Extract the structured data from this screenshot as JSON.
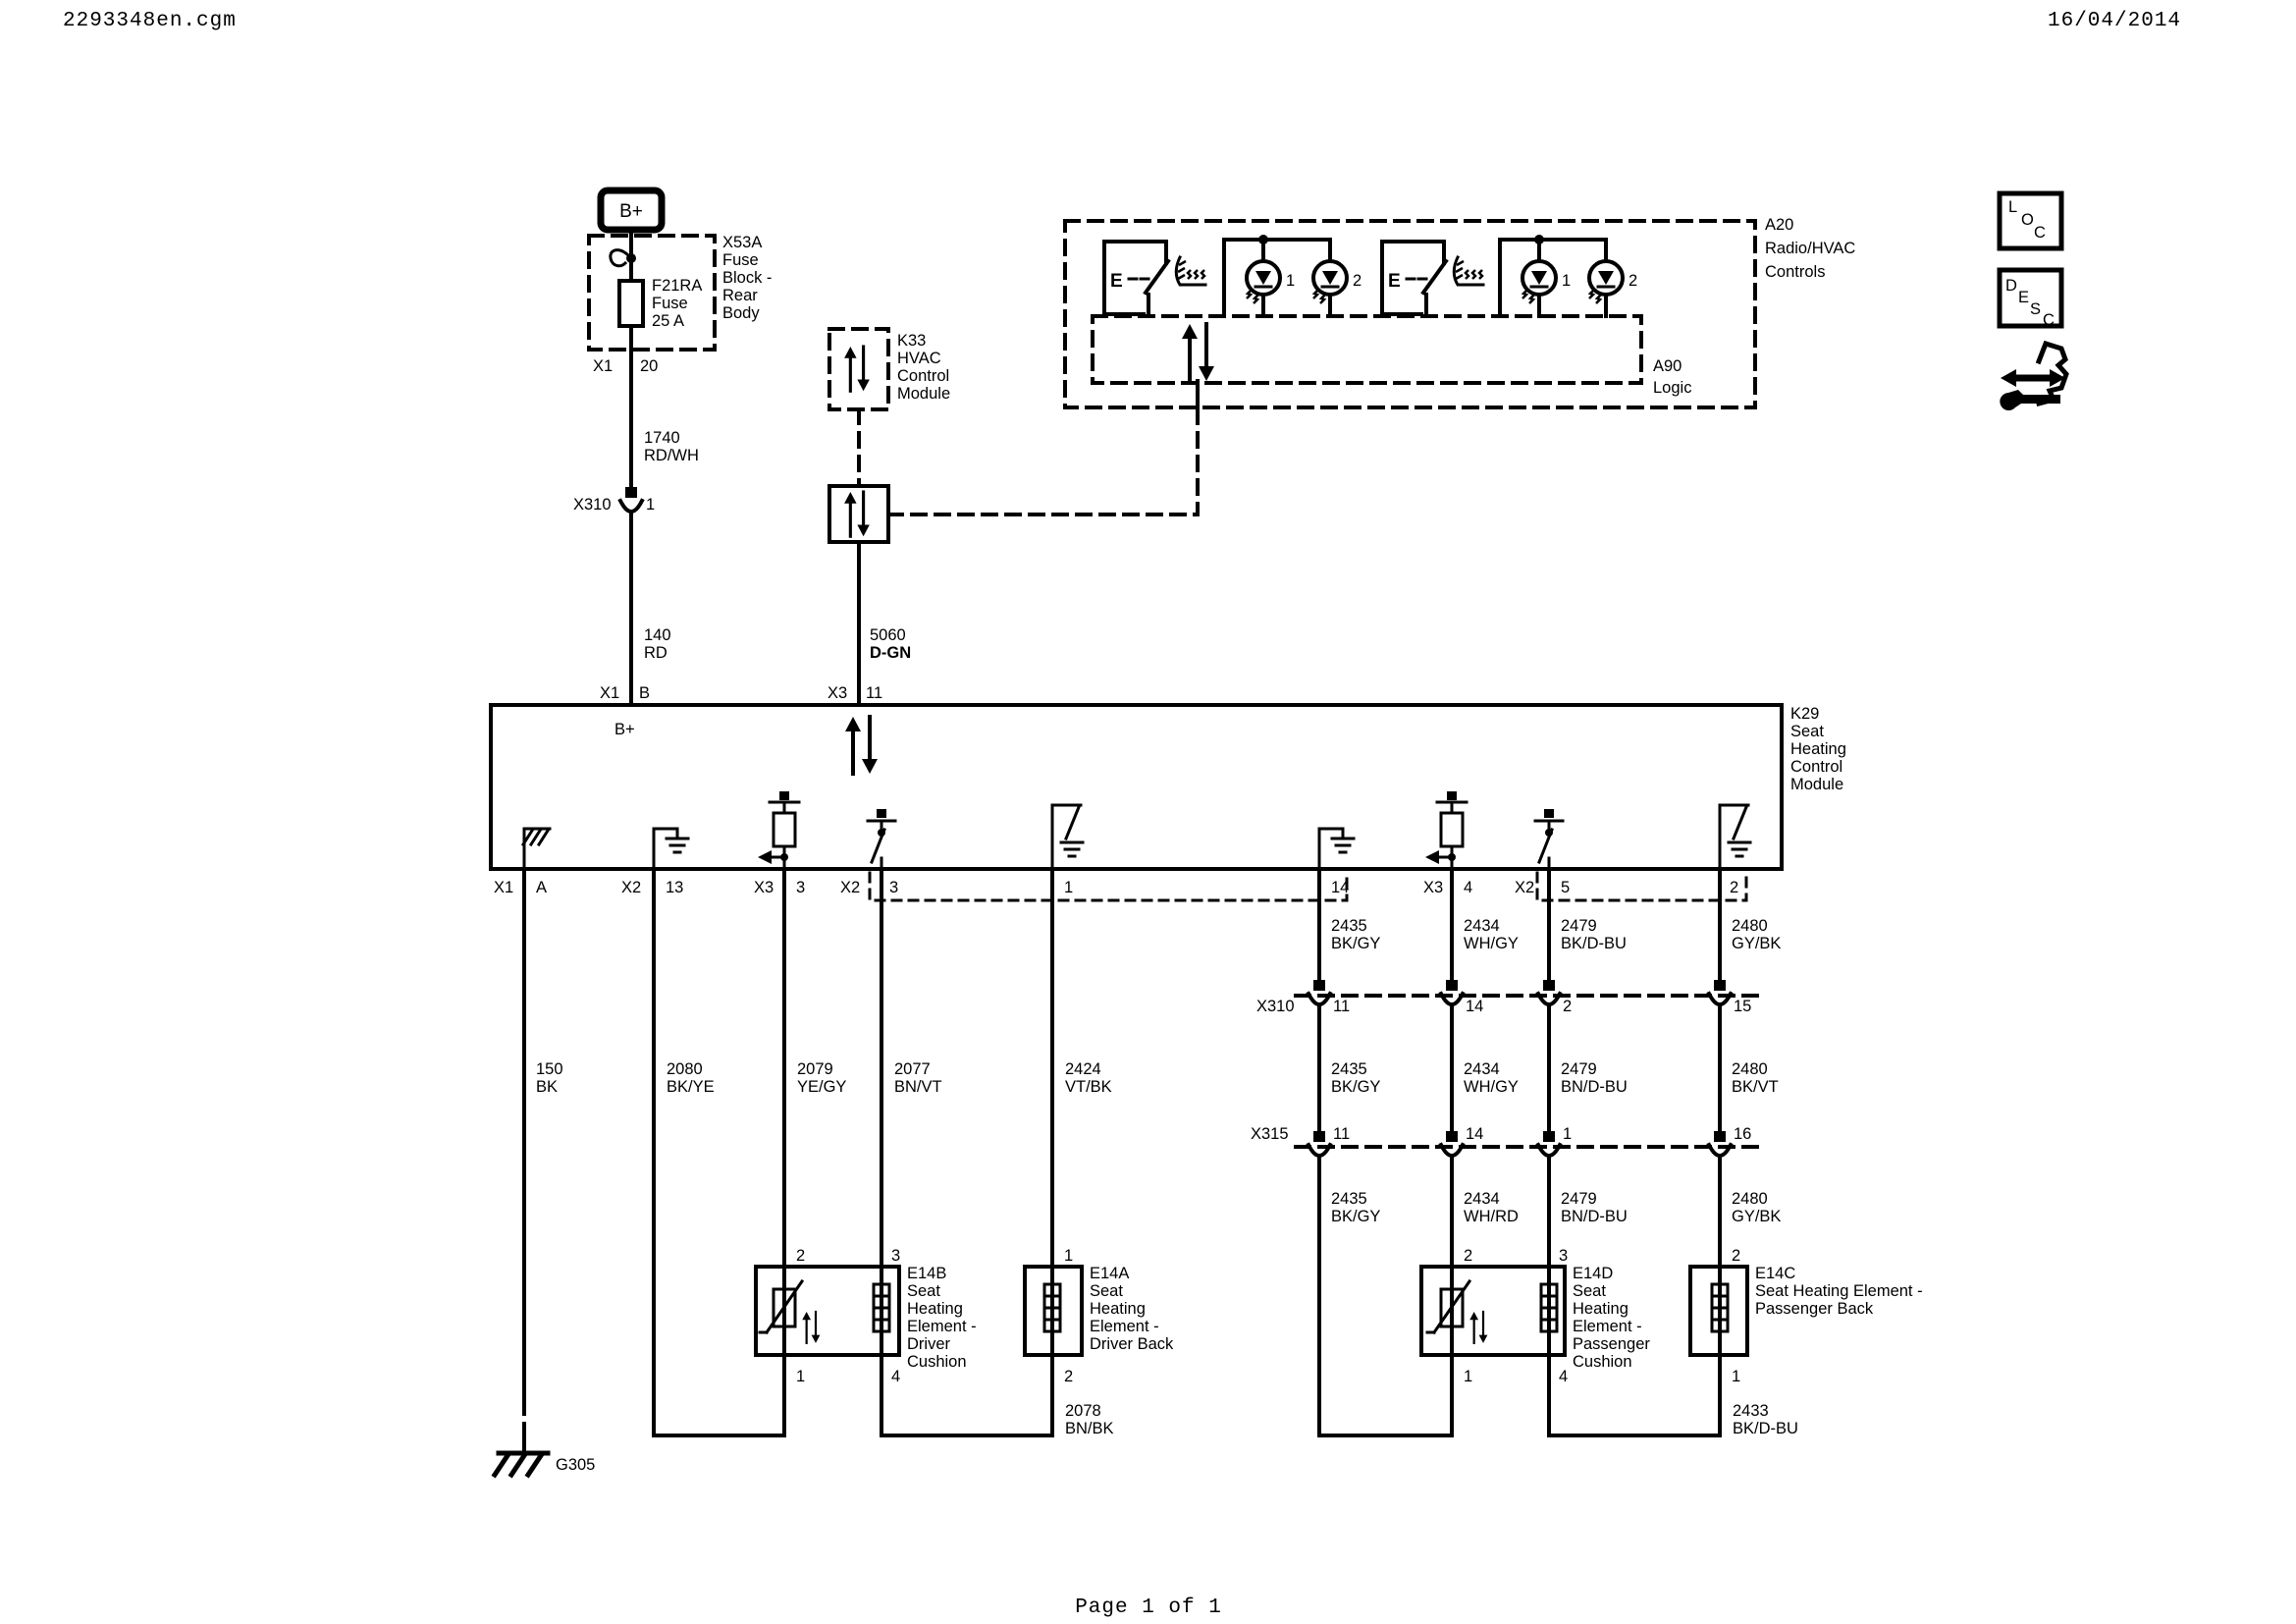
{
  "header": {
    "filename": "2293348en.cgm",
    "date": "16/04/2014"
  },
  "footer": {
    "page_label": "Page 1 of 1"
  },
  "colors": {
    "ink": "#000000",
    "paper": "#ffffff"
  },
  "battery": {
    "label": "B+"
  },
  "fuse_block": {
    "ref": "X53A",
    "name": [
      "Fuse",
      "Block -",
      "Rear",
      "Body"
    ],
    "fuse": {
      "ref": "F21RA",
      "kind": "Fuse",
      "rating": "25 A"
    },
    "pin_conn": "X1",
    "pin_num": "20"
  },
  "k33": {
    "ref": "K33",
    "name": [
      "HVAC",
      "Control",
      "Module"
    ]
  },
  "a20": {
    "ref": "A20",
    "name": [
      "Radio/HVAC",
      "Controls"
    ],
    "switch1_label": "E",
    "switch2_label": "E",
    "led_labels": [
      "1",
      "2",
      "1",
      "2"
    ],
    "a90": {
      "ref": "A90",
      "name": "Logic"
    }
  },
  "k29": {
    "ref": "K29",
    "name": [
      "Seat",
      "Heating",
      "Control",
      "Module"
    ],
    "internal_bplus": "B+",
    "top_pins": [
      {
        "conn": "X1",
        "num": "B"
      },
      {
        "conn": "X3",
        "num": "11"
      }
    ],
    "bottom_pins": [
      {
        "conn": "X1",
        "num": "A"
      },
      {
        "conn": "X2",
        "num": "13"
      },
      {
        "conn": "X3",
        "num": "3"
      },
      {
        "conn": "X2",
        "num": "3"
      },
      {
        "num": "1"
      },
      {
        "num": "14"
      },
      {
        "conn": "X3",
        "num": "4"
      },
      {
        "conn": "X2",
        "num": "5"
      },
      {
        "num": "2"
      }
    ]
  },
  "wires": {
    "c1740": {
      "id": "1740",
      "color": "RD/WH"
    },
    "c140": {
      "id": "140",
      "color": "RD"
    },
    "c5060": {
      "id": "5060",
      "color": "D-GN"
    },
    "c150": {
      "id": "150",
      "color": "BK"
    },
    "c2080": {
      "id": "2080",
      "color": "BK/YE"
    },
    "c2079": {
      "id": "2079",
      "color": "YE/GY"
    },
    "c2077": {
      "id": "2077",
      "color": "BN/VT"
    },
    "c2424": {
      "id": "2424",
      "color": "VT/BK"
    },
    "c2435_a": {
      "id": "2435",
      "color": "BK/GY"
    },
    "c2435_b": {
      "id": "2435",
      "color": "BK/GY"
    },
    "c2435_c": {
      "id": "2435",
      "color": "BK/GY"
    },
    "c2434_a": {
      "id": "2434",
      "color": "WH/GY"
    },
    "c2434_b": {
      "id": "2434",
      "color": "WH/GY"
    },
    "c2434_c": {
      "id": "2434",
      "color": "WH/RD"
    },
    "c2479_a": {
      "id": "2479",
      "color": "BK/D-BU"
    },
    "c2479_b": {
      "id": "2479",
      "color": "BN/D-BU"
    },
    "c2479_c": {
      "id": "2479",
      "color": "BN/D-BU"
    },
    "c2480_a": {
      "id": "2480",
      "color": "GY/BK"
    },
    "c2480_b": {
      "id": "2480",
      "color": "BK/VT"
    },
    "c2480_c": {
      "id": "2480",
      "color": "GY/BK"
    },
    "c2078": {
      "id": "2078",
      "color": "BN/BK"
    },
    "c2433": {
      "id": "2433",
      "color": "BK/D-BU"
    }
  },
  "connectors": {
    "x310_inline": {
      "name": "X310",
      "pin": "1"
    },
    "x310": {
      "name": "X310",
      "pins": [
        "11",
        "14",
        "2",
        "15"
      ]
    },
    "x315": {
      "name": "X315",
      "pins": [
        "11",
        "14",
        "1",
        "16"
      ]
    }
  },
  "elements": {
    "e14b": {
      "ref": "E14B",
      "name": [
        "Seat",
        "Heating",
        "Element -",
        "Driver",
        "Cushion"
      ],
      "pin_top_left": "2",
      "pin_top_right": "3",
      "pin_bot_left": "1",
      "pin_bot_right": "4"
    },
    "e14a": {
      "ref": "E14A",
      "name": [
        "Seat",
        "Heating",
        "Element -",
        "Driver Back"
      ],
      "pin_top": "1",
      "pin_bot": "2"
    },
    "e14d": {
      "ref": "E14D",
      "name": [
        "Seat",
        "Heating",
        "Element -",
        "Passenger",
        "Cushion"
      ],
      "pin_top_left": "2",
      "pin_top_right": "3",
      "pin_bot_left": "1",
      "pin_bot_right": "4"
    },
    "e14c": {
      "ref": "E14C",
      "name": [
        "Seat Heating Element -",
        "Passenger Back"
      ],
      "pin_top": "2",
      "pin_bot": "1"
    }
  },
  "ground": {
    "g305": "G305"
  },
  "legend": {
    "loc": [
      "L",
      "O",
      "C"
    ],
    "desc": [
      "D",
      "E",
      "S",
      "C"
    ]
  }
}
